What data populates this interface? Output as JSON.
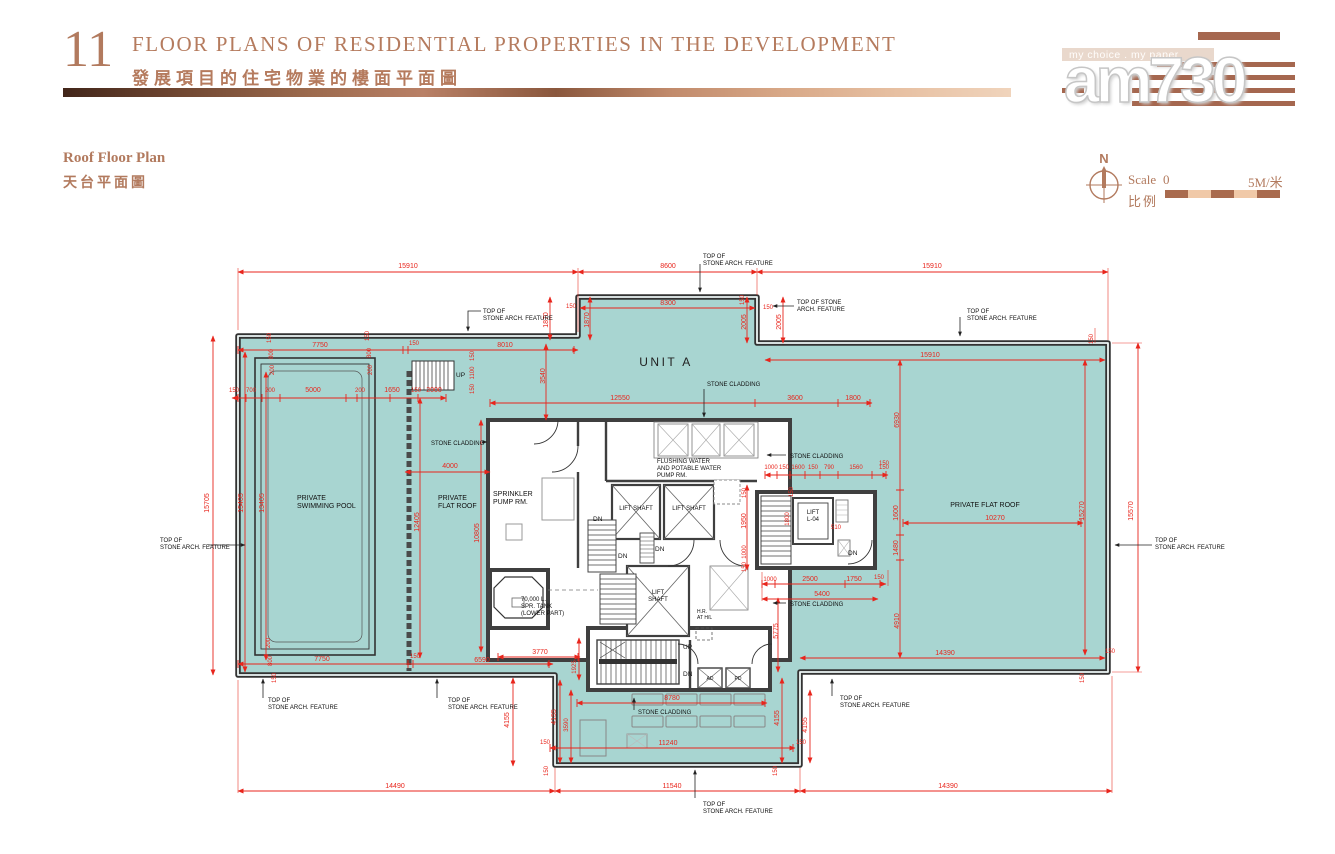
{
  "header": {
    "number": "11",
    "title_en": "FLOOR PLANS OF RESIDENTIAL PROPERTIES IN THE DEVELOPMENT",
    "title_zh": "發展項目的住宅物業的樓面平面圖"
  },
  "logo": {
    "tagline": "my choice . my paper",
    "name": "am730"
  },
  "plan_title": {
    "en": "Roof Floor Plan",
    "zh": "天台平面圖"
  },
  "compass": {
    "north": "N"
  },
  "scale": {
    "label_en": "Scale",
    "label_zh": "比例",
    "zero": "0",
    "max": "5M/米"
  },
  "colors": {
    "accent_copper": "#b27a5e",
    "roof_teal": "#a8d5d1",
    "dim_red": "#e8251c",
    "wall_dark": "#3f3f3f"
  },
  "plan": {
    "labels": [
      {
        "t": "15910",
        "x": 408,
        "y": 268
      },
      {
        "t": "8600",
        "x": 668,
        "y": 268
      },
      {
        "t": "15910",
        "x": 932,
        "y": 268
      },
      {
        "t": "8300",
        "x": 668,
        "y": 305
      },
      {
        "t": "150",
        "x": 571,
        "y": 308,
        "f": 6
      },
      {
        "t": "150",
        "x": 768,
        "y": 309,
        "f": 6
      },
      {
        "t": "1870",
        "x": 548,
        "y": 320,
        "r": -90
      },
      {
        "t": "1870",
        "x": 589,
        "y": 320,
        "r": -90
      },
      {
        "t": "150",
        "x": 744,
        "y": 300,
        "r": -90,
        "f": 6
      },
      {
        "t": "2005",
        "x": 746,
        "y": 322,
        "r": -90
      },
      {
        "t": "2005",
        "x": 781,
        "y": 322,
        "r": -90
      },
      {
        "t": "7750",
        "x": 320,
        "y": 347
      },
      {
        "t": "150",
        "x": 414,
        "y": 345,
        "f": 6
      },
      {
        "t": "8010",
        "x": 505,
        "y": 347
      },
      {
        "t": "150",
        "x": 271,
        "y": 338,
        "r": -90,
        "f": 6
      },
      {
        "t": "800",
        "x": 273,
        "y": 354,
        "r": -90,
        "f": 6
      },
      {
        "t": "200",
        "x": 274,
        "y": 370,
        "r": -90,
        "f": 6
      },
      {
        "t": "150",
        "x": 369,
        "y": 336,
        "r": -90,
        "f": 6
      },
      {
        "t": "800",
        "x": 371,
        "y": 353,
        "r": -90,
        "f": 6
      },
      {
        "t": "200",
        "x": 372,
        "y": 370,
        "r": -90,
        "f": 6
      },
      {
        "t": "150",
        "x": 474,
        "y": 356,
        "r": -90,
        "f": 6
      },
      {
        "t": "1100",
        "x": 474,
        "y": 373,
        "r": -90,
        "f": 6
      },
      {
        "t": "150",
        "x": 474,
        "y": 389,
        "r": -90,
        "f": 6
      },
      {
        "t": "3540",
        "x": 545,
        "y": 376,
        "r": -90
      },
      {
        "t": "150",
        "x": 234,
        "y": 392,
        "f": 6
      },
      {
        "t": "700",
        "x": 251,
        "y": 392,
        "f": 6
      },
      {
        "t": "200",
        "x": 270,
        "y": 392,
        "f": 6
      },
      {
        "t": "5000",
        "x": 313,
        "y": 392
      },
      {
        "t": "200",
        "x": 360,
        "y": 392,
        "f": 6
      },
      {
        "t": "1650",
        "x": 392,
        "y": 392
      },
      {
        "t": "150",
        "x": 416,
        "y": 392,
        "f": 6
      },
      {
        "t": "2000",
        "x": 434,
        "y": 392
      },
      {
        "t": "15910",
        "x": 930,
        "y": 357
      },
      {
        "t": "12550",
        "x": 620,
        "y": 400
      },
      {
        "t": "3600",
        "x": 795,
        "y": 400
      },
      {
        "t": "1800",
        "x": 853,
        "y": 400
      },
      {
        "t": "6930",
        "x": 899,
        "y": 420,
        "r": -90
      },
      {
        "t": "150",
        "x": 1093,
        "y": 339,
        "r": -90,
        "f": 6
      },
      {
        "t": "4000",
        "x": 450,
        "y": 468
      },
      {
        "t": "15705",
        "x": 209,
        "y": 503,
        "r": -90
      },
      {
        "t": "15405",
        "x": 243,
        "y": 503,
        "r": -90
      },
      {
        "t": "13405",
        "x": 264,
        "y": 503,
        "r": -90
      },
      {
        "t": "12405",
        "x": 419,
        "y": 522,
        "r": -90
      },
      {
        "t": "10805",
        "x": 479,
        "y": 533,
        "r": -90
      },
      {
        "t": "1000",
        "x": 771,
        "y": 469,
        "f": 6
      },
      {
        "t": "150",
        "x": 784,
        "y": 469,
        "f": 6
      },
      {
        "t": "1600",
        "x": 798,
        "y": 469,
        "f": 6
      },
      {
        "t": "150",
        "x": 813,
        "y": 469,
        "f": 6
      },
      {
        "t": "790",
        "x": 829,
        "y": 469,
        "f": 6
      },
      {
        "t": "1560",
        "x": 856,
        "y": 469,
        "f": 6
      },
      {
        "t": "150",
        "x": 884,
        "y": 469,
        "f": 6
      },
      {
        "t": "150",
        "x": 793,
        "y": 492,
        "r": -90,
        "f": 6
      },
      {
        "t": "1800",
        "x": 789,
        "y": 519,
        "r": -90,
        "f": 6
      },
      {
        "t": "510",
        "x": 836,
        "y": 529,
        "f": 6
      },
      {
        "t": "150",
        "x": 746,
        "y": 493,
        "r": -90,
        "f": 6
      },
      {
        "t": "1950",
        "x": 746,
        "y": 521,
        "r": -90
      },
      {
        "t": "1000",
        "x": 746,
        "y": 552,
        "r": -90,
        "f": 6
      },
      {
        "t": "150",
        "x": 746,
        "y": 567,
        "r": -90,
        "f": 6
      },
      {
        "t": "150",
        "x": 884,
        "y": 465,
        "f": 6
      },
      {
        "t": "1600",
        "x": 898,
        "y": 513,
        "r": -90
      },
      {
        "t": "1480",
        "x": 898,
        "y": 548,
        "r": -90
      },
      {
        "t": "4910",
        "x": 899,
        "y": 621,
        "r": -90
      },
      {
        "t": "15270",
        "x": 1084,
        "y": 511,
        "r": -90
      },
      {
        "t": "15570",
        "x": 1133,
        "y": 511,
        "r": -90
      },
      {
        "t": "10270",
        "x": 995,
        "y": 520
      },
      {
        "t": "1000",
        "x": 770,
        "y": 581,
        "f": 6
      },
      {
        "t": "2500",
        "x": 810,
        "y": 581
      },
      {
        "t": "1750",
        "x": 854,
        "y": 581
      },
      {
        "t": "150",
        "x": 879,
        "y": 579,
        "f": 6
      },
      {
        "t": "5400",
        "x": 822,
        "y": 596
      },
      {
        "t": "5775",
        "x": 778,
        "y": 631,
        "r": -90
      },
      {
        "t": "3770",
        "x": 540,
        "y": 654
      },
      {
        "t": "6590",
        "x": 482,
        "y": 662
      },
      {
        "t": "7750",
        "x": 322,
        "y": 661
      },
      {
        "t": "150",
        "x": 415,
        "y": 658,
        "f": 6
      },
      {
        "t": "200",
        "x": 270,
        "y": 643,
        "r": -90,
        "f": 6
      },
      {
        "t": "800",
        "x": 272,
        "y": 661,
        "r": -90,
        "f": 6
      },
      {
        "t": "150",
        "x": 276,
        "y": 678,
        "r": -90,
        "f": 6
      },
      {
        "t": "14390",
        "x": 945,
        "y": 655
      },
      {
        "t": "150",
        "x": 1110,
        "y": 653,
        "f": 6
      },
      {
        "t": "150",
        "x": 1084,
        "y": 678,
        "r": -90,
        "f": 6
      },
      {
        "t": "1925",
        "x": 576,
        "y": 667,
        "r": -90,
        "f": 6
      },
      {
        "t": "4155",
        "x": 509,
        "y": 720,
        "r": -90
      },
      {
        "t": "4155",
        "x": 556,
        "y": 717,
        "r": -90
      },
      {
        "t": "3590",
        "x": 568,
        "y": 725,
        "r": -90,
        "f": 6
      },
      {
        "t": "8780",
        "x": 672,
        "y": 700
      },
      {
        "t": "4155",
        "x": 779,
        "y": 718,
        "r": -90
      },
      {
        "t": "4155",
        "x": 807,
        "y": 725,
        "r": -90
      },
      {
        "t": "11240",
        "x": 668,
        "y": 745
      },
      {
        "t": "150",
        "x": 545,
        "y": 744,
        "f": 6
      },
      {
        "t": "150",
        "x": 801,
        "y": 744,
        "f": 6
      },
      {
        "t": "150",
        "x": 548,
        "y": 771,
        "r": -90,
        "f": 6
      },
      {
        "t": "150",
        "x": 777,
        "y": 771,
        "r": -90,
        "f": 6
      },
      {
        "t": "14490",
        "x": 395,
        "y": 788
      },
      {
        "t": "11540",
        "x": 672,
        "y": 788
      },
      {
        "t": "14390",
        "x": 948,
        "y": 788
      },
      {
        "t": "TOP OF\nSTONE ARCH. FEATURE",
        "x": 483,
        "y": 313,
        "c": "ann",
        "f": 6,
        "a": "s"
      },
      {
        "t": "TOP OF\nSTONE ARCH. FEATURE",
        "x": 703,
        "y": 258,
        "c": "ann",
        "f": 6,
        "a": "s"
      },
      {
        "t": "TOP OF STONE\nARCH. FEATURE",
        "x": 797,
        "y": 304,
        "c": "ann",
        "f": 6,
        "a": "s"
      },
      {
        "t": "TOP OF\nSTONE ARCH. FEATURE",
        "x": 967,
        "y": 313,
        "c": "ann",
        "f": 6,
        "a": "s"
      },
      {
        "t": "TOP OF\nSTONE ARCH. FEATURE",
        "x": 160,
        "y": 542,
        "c": "ann",
        "f": 6,
        "a": "s"
      },
      {
        "t": "TOP OF\nSTONE ARCH. FEATURE",
        "x": 1155,
        "y": 542,
        "c": "ann",
        "f": 6,
        "a": "s"
      },
      {
        "t": "TOP OF\nSTONE ARCH. FEATURE",
        "x": 268,
        "y": 702,
        "c": "ann",
        "f": 6,
        "a": "s"
      },
      {
        "t": "TOP OF\nSTONE ARCH. FEATURE",
        "x": 448,
        "y": 702,
        "c": "ann",
        "f": 6,
        "a": "s"
      },
      {
        "t": "TOP OF\nSTONE ARCH. FEATURE",
        "x": 840,
        "y": 700,
        "c": "ann",
        "f": 6,
        "a": "s"
      },
      {
        "t": "TOP OF\nSTONE ARCH. FEATURE",
        "x": 703,
        "y": 806,
        "c": "ann",
        "f": 6,
        "a": "s"
      },
      {
        "t": "STONE CLADDING",
        "x": 707,
        "y": 386,
        "c": "ann",
        "f": 6,
        "a": "s"
      },
      {
        "t": "STONE CLADDING",
        "x": 431,
        "y": 445,
        "c": "ann",
        "f": 6,
        "a": "s"
      },
      {
        "t": "STONE CLADDING",
        "x": 790,
        "y": 458,
        "c": "ann",
        "f": 6,
        "a": "s"
      },
      {
        "t": "STONE CLADDING",
        "x": 790,
        "y": 606,
        "c": "ann",
        "f": 6,
        "a": "s"
      },
      {
        "t": "STONE CLADDING",
        "x": 638,
        "y": 714,
        "c": "ann",
        "f": 6,
        "a": "s"
      },
      {
        "t": "UNIT A",
        "x": 666,
        "y": 366,
        "c": "unit",
        "f": 12
      },
      {
        "t": "PRIVATE\nSWIMMING POOL",
        "x": 297,
        "y": 500,
        "c": "room",
        "a": "s"
      },
      {
        "t": "PRIVATE\nFLAT ROOF",
        "x": 438,
        "y": 500,
        "c": "room",
        "a": "s"
      },
      {
        "t": "PRIVATE FLAT ROOF",
        "x": 985,
        "y": 507,
        "c": "room"
      },
      {
        "t": "SPRINKLER\nPUMP RM.",
        "x": 493,
        "y": 496,
        "c": "room",
        "a": "s"
      },
      {
        "t": "FLUSHING WATER\nAND POTABLE WATER\nPUMP RM.",
        "x": 657,
        "y": 463,
        "c": "room",
        "f": 6,
        "a": "s"
      },
      {
        "t": "LIFT SHAFT",
        "x": 636,
        "y": 510,
        "c": "room",
        "f": 6
      },
      {
        "t": "LIFT SHAFT",
        "x": 689,
        "y": 510,
        "c": "room",
        "f": 6
      },
      {
        "t": "LIFT\nSHAFT",
        "x": 658,
        "y": 594,
        "c": "room",
        "f": 6
      },
      {
        "t": "LIFT\nL-04",
        "x": 813,
        "y": 514,
        "c": "room",
        "f": 6
      },
      {
        "t": "70,000 L.\nSPR. TANK\n(LOWER PART)",
        "x": 521,
        "y": 601,
        "c": "room",
        "f": 6,
        "a": "s"
      },
      {
        "t": "H.R.\nAT H/L",
        "x": 697,
        "y": 613,
        "c": "room",
        "f": 5,
        "a": "s"
      },
      {
        "t": "UP",
        "x": 456,
        "y": 377,
        "c": "room",
        "f": 6.5,
        "a": "s"
      },
      {
        "t": "UP",
        "x": 683,
        "y": 649,
        "c": "room",
        "f": 6.5,
        "a": "s"
      },
      {
        "t": "DN",
        "x": 683,
        "y": 676,
        "c": "room",
        "f": 6.5,
        "a": "s"
      },
      {
        "t": "DN",
        "x": 593,
        "y": 521,
        "c": "room",
        "f": 6.5,
        "a": "s"
      },
      {
        "t": "DN",
        "x": 618,
        "y": 558,
        "c": "room",
        "f": 6.5,
        "a": "s"
      },
      {
        "t": "DN",
        "x": 655,
        "y": 551,
        "c": "room",
        "f": 6.5,
        "a": "s"
      },
      {
        "t": "DN",
        "x": 848,
        "y": 555,
        "c": "room",
        "f": 6.5,
        "a": "s"
      },
      {
        "t": "AD",
        "x": 710,
        "y": 680,
        "c": "room",
        "f": 5
      },
      {
        "t": "PD",
        "x": 738,
        "y": 680,
        "c": "room",
        "f": 5
      }
    ]
  }
}
